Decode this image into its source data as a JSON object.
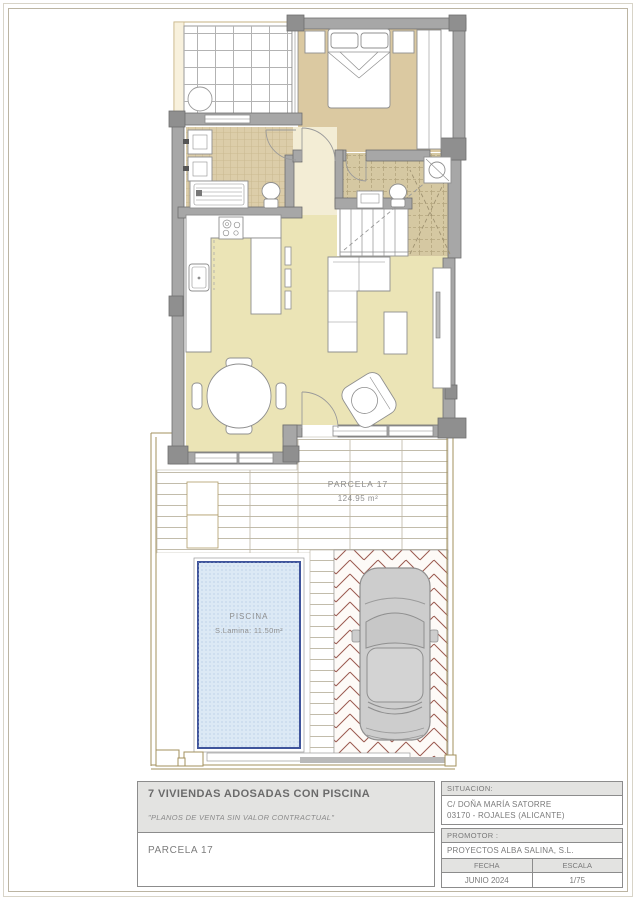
{
  "plan": {
    "parcel_label": "PARCELA 17",
    "parcel_area": "124.95 m²",
    "pool_label": "PISCINA",
    "pool_area": "S.Lamina: 11.50m²"
  },
  "title_block": {
    "project_title": "7 VIVIENDAS ADOSADAS CON PISCINA",
    "disclaimer": "\"PLANOS DE VENTA SIN VALOR CONTRACTUAL\"",
    "sheet_name": "PARCELA 17",
    "situacion": {
      "label": "SITUACION:",
      "address_line1": "C/ DOÑA MARÍA SATORRE",
      "address_line2": "03170 - ROJALES (ALICANTE)"
    },
    "promotor": {
      "label": "PROMOTOR :",
      "value": "PROYECTOS ALBA SALINA, S.L."
    },
    "fecha": {
      "label": "FECHA",
      "value": "JUNIO 2024"
    },
    "escala": {
      "label": "ESCALA",
      "value": "1/75"
    }
  },
  "colors": {
    "wall_gray": "#a7a7a7",
    "wall_dark": "#8f8f8f",
    "bedroom_floor": "#dbc9a1",
    "living_floor": "#ebe4b6",
    "bathroom_tile": "#dccda9",
    "hall_floor": "#f3edd5",
    "pool_fill": "#dce9f5",
    "pool_border": "#3f549b",
    "paving_brick": "#9b5a50",
    "boundary_tan": "#a3905e",
    "car_body": "#cdcdcd"
  }
}
